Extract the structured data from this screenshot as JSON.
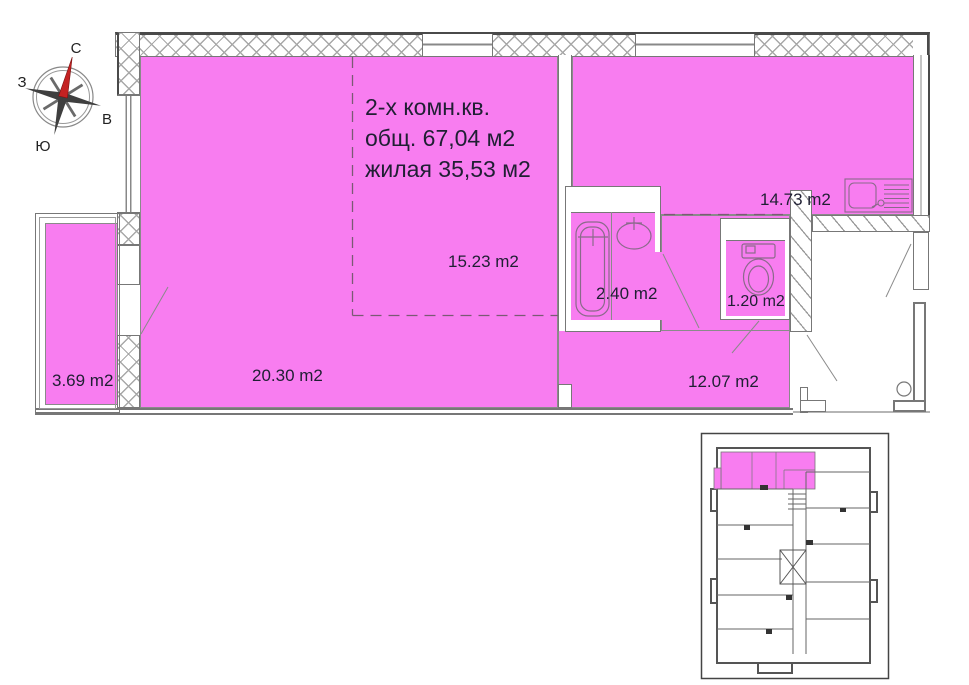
{
  "title": {
    "line1": "2-х комн.кв.",
    "line2": "общ. 67,04 м2",
    "line3": "жилая 35,53 м2"
  },
  "rooms": {
    "living": {
      "area": "20.30 m2"
    },
    "bedroom": {
      "area": "15.23 m2"
    },
    "kitchen": {
      "area": "14.73 m2"
    },
    "hallway": {
      "area": "12.07 m2"
    },
    "bathroom": {
      "area": "2.40 m2"
    },
    "wc": {
      "area": "1.20 m2"
    },
    "balcony": {
      "area": "3.69 m2"
    }
  },
  "compass": {
    "north": "С",
    "east": "В",
    "south": "Ю",
    "west": "З"
  },
  "colors": {
    "room_highlight": "#f87df0",
    "compass_needle": "#c42222",
    "walls": "#6e6e6e",
    "label_text": "#1f1f33"
  }
}
